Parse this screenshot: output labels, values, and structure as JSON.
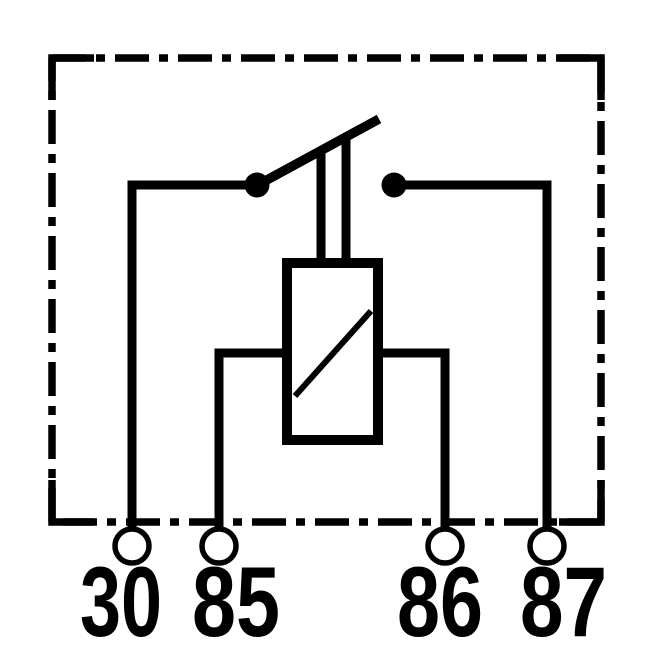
{
  "page": {
    "background_color": "#ffffff",
    "line_color": "#000000"
  },
  "diagram": {
    "kind": "automotive-relay-schematic",
    "terminals": [
      {
        "id": "30",
        "label": "30"
      },
      {
        "id": "85",
        "label": "85"
      },
      {
        "id": "86",
        "label": "86"
      },
      {
        "id": "87",
        "label": "87"
      }
    ]
  }
}
